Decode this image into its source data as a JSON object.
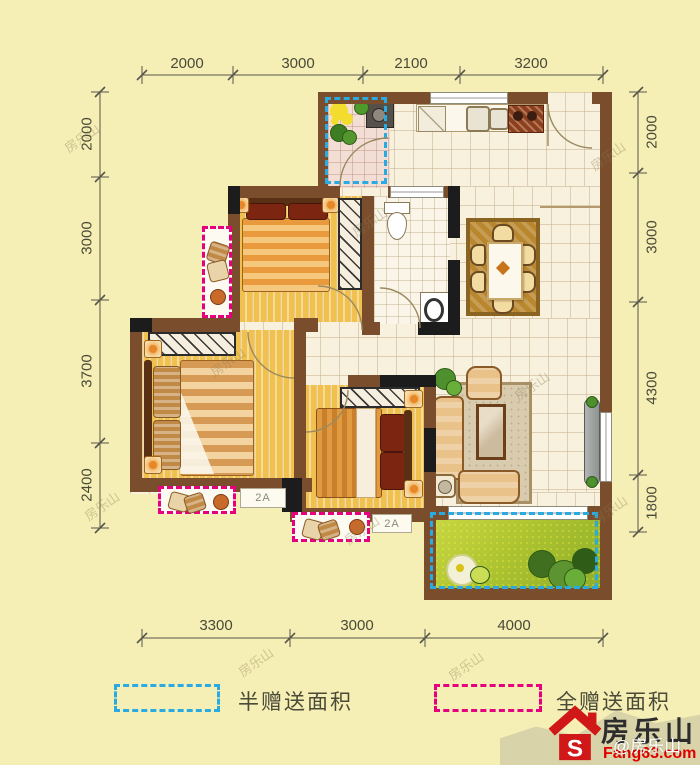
{
  "dimensions": {
    "top": [
      "2000",
      "3000",
      "2100",
      "3200"
    ],
    "left": [
      "2000",
      "3000",
      "3700",
      "2400"
    ],
    "right": [
      "2000",
      "3000",
      "4300",
      "1800"
    ],
    "bottom": [
      "3300",
      "3000",
      "4000"
    ]
  },
  "annotations": {
    "ac_label_1": "2A",
    "ac_label_2": "2A"
  },
  "legend": {
    "half_gift_label": "半赠送面积",
    "full_gift_label": "全赠送面积"
  },
  "logo": {
    "brand": "房乐山",
    "site": "Fang63.com",
    "watermark": "@房乐山"
  },
  "watermark": "房乐山",
  "colors": {
    "background": "#f5eeb5",
    "wall": "#7a4e2c",
    "wall_dark": "#1c1c1c",
    "wood": "#f0c14e",
    "half_gift": "#29abe2",
    "full_gift": "#e5007d",
    "grass": "#aec431",
    "logo_red": "#d01818",
    "dim_line": "#56564a"
  }
}
